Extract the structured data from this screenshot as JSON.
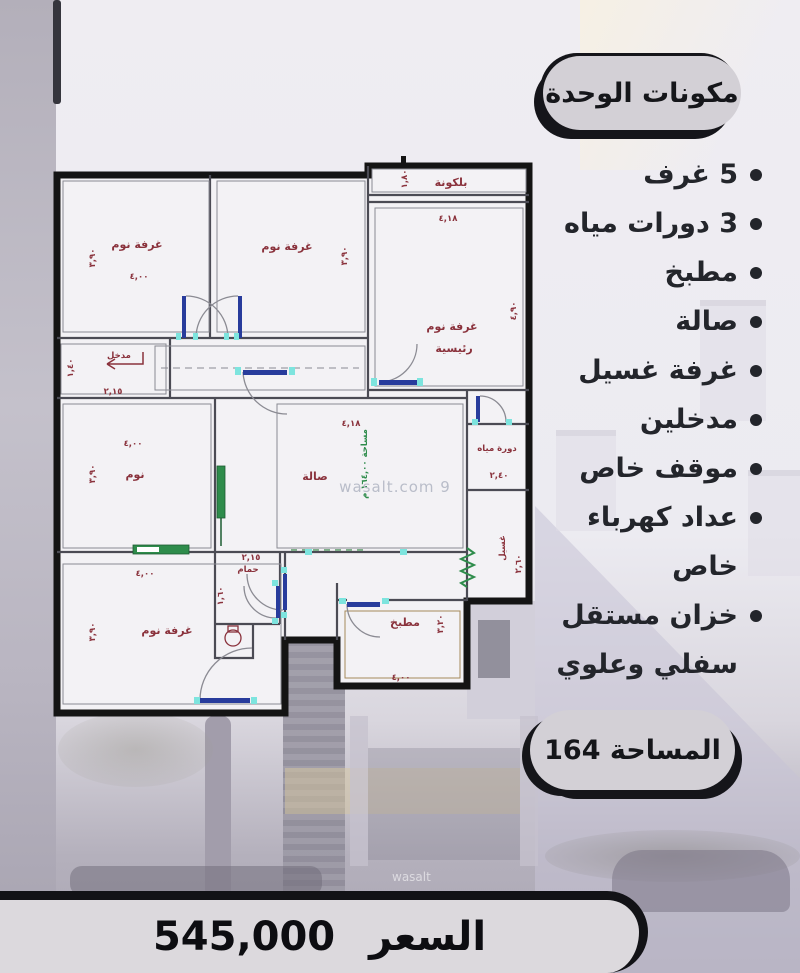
{
  "side_panel": {
    "title": "مكونات الوحدة",
    "items": [
      "5 غرف",
      "3 دورات مياه",
      "مطبخ",
      "صالة",
      "غرفة غسيل",
      "مدخلين",
      "موقف خاص",
      "عداد كهرباء خاص",
      "خزان مستقل سفلي وعلوي"
    ],
    "area_badge": "المساحة 164"
  },
  "price_bar": {
    "label": "السعر",
    "value": "545,000"
  },
  "photo_watermark": "wasalt",
  "floor_plan": {
    "watermark": "wasalt.com 9",
    "area_note": "مساحة ١٦٤,٠٠ م",
    "rooms": {
      "bedroom_top_left": "غرفة نوم",
      "bedroom_top_mid": "غرفة نوم",
      "balcony": "بلكونة",
      "master_l1": "غرفة نوم",
      "master_l2": "رئيسية",
      "entry": "مدخل",
      "bedroom_mid_left": "نوم",
      "hall": "صالة",
      "wc": "دورة مياه",
      "laundry": "غسيل",
      "bedroom_bottom_left": "غرفة نوم",
      "bathroom": "حمام",
      "kitchen": "مطبخ"
    },
    "dims": {
      "d390a": "٣,٩٠",
      "d400a": "٤,٠٠",
      "d390b": "٣,٩٠",
      "d180": "١,٨٠",
      "d418a": "٤,١٨",
      "d490": "٤,٩٠",
      "d140": "١,٤٠",
      "d215a": "٢,١٥",
      "d400b": "٤,٠٠",
      "d390c": "٣,٩٠",
      "d418b": "٤,١٨",
      "d240": "٢,٤٠",
      "d260": "٢,٦٠",
      "d390d": "٣,٩٠",
      "d400c": "٤,٠٠",
      "d160": "١,٦٠",
      "d215b": "٢,١٥",
      "d320": "٣,٢٠",
      "d400d": "٤,٠٠"
    },
    "colors": {
      "dim_text": "#8a323c",
      "fixtures_green": "#2e8c4b",
      "door_blue": "#283c9c",
      "opening_cyan": "#7de4de",
      "outline_black": "#141414",
      "pill_gray": "#d3d0d6"
    }
  }
}
